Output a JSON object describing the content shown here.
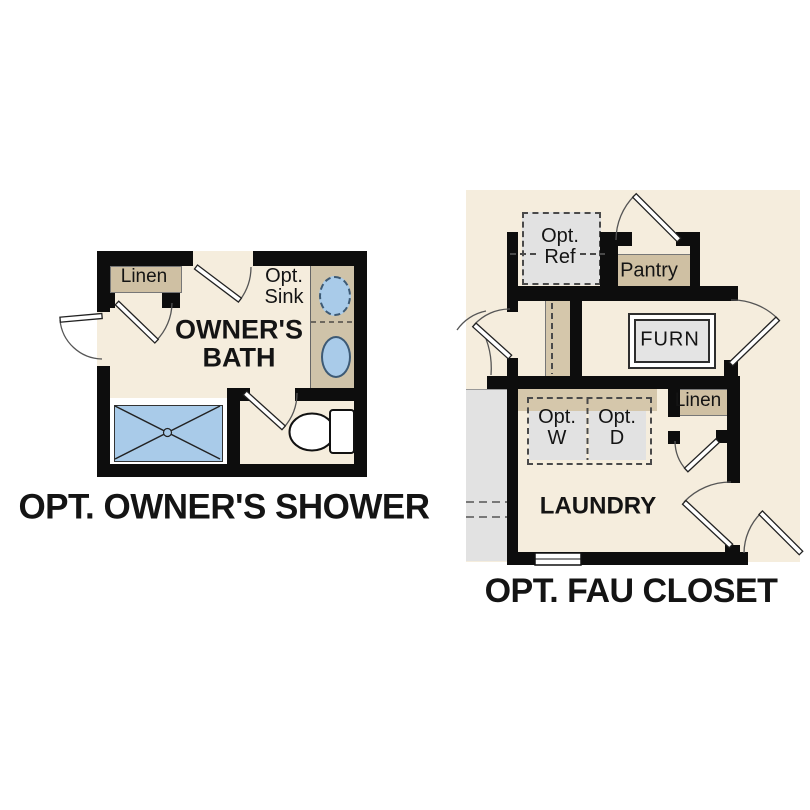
{
  "left_plan": {
    "caption": "OPT. OWNER'S SHOWER",
    "bath_label_line1": "OWNER'S",
    "bath_label_line2": "BATH",
    "linen_label": "Linen",
    "opt_sink_line1": "Opt.",
    "opt_sink_line2": "Sink"
  },
  "right_plan": {
    "caption": "OPT. FAU CLOSET",
    "laundry_label": "LAUNDRY",
    "pantry_label": "Pantry",
    "furn_label": "FURN",
    "linen_label": "Linen",
    "opt_ref_line1": "Opt.",
    "opt_ref_line2": "Ref",
    "opt_washer_line1": "Opt.",
    "opt_washer_line2": "W",
    "opt_dryer_line1": "Opt.",
    "opt_dryer_line2": "D"
  },
  "colors": {
    "wall": "#0d0d0d",
    "floor_cream": "#f5eddd",
    "cabinet_tan": "#cfc0a3",
    "counter_tan": "#d5c7ab",
    "fixture_blue": "#a9cbe9",
    "optional_gray": "#e2e2e2",
    "text": "#141414"
  }
}
